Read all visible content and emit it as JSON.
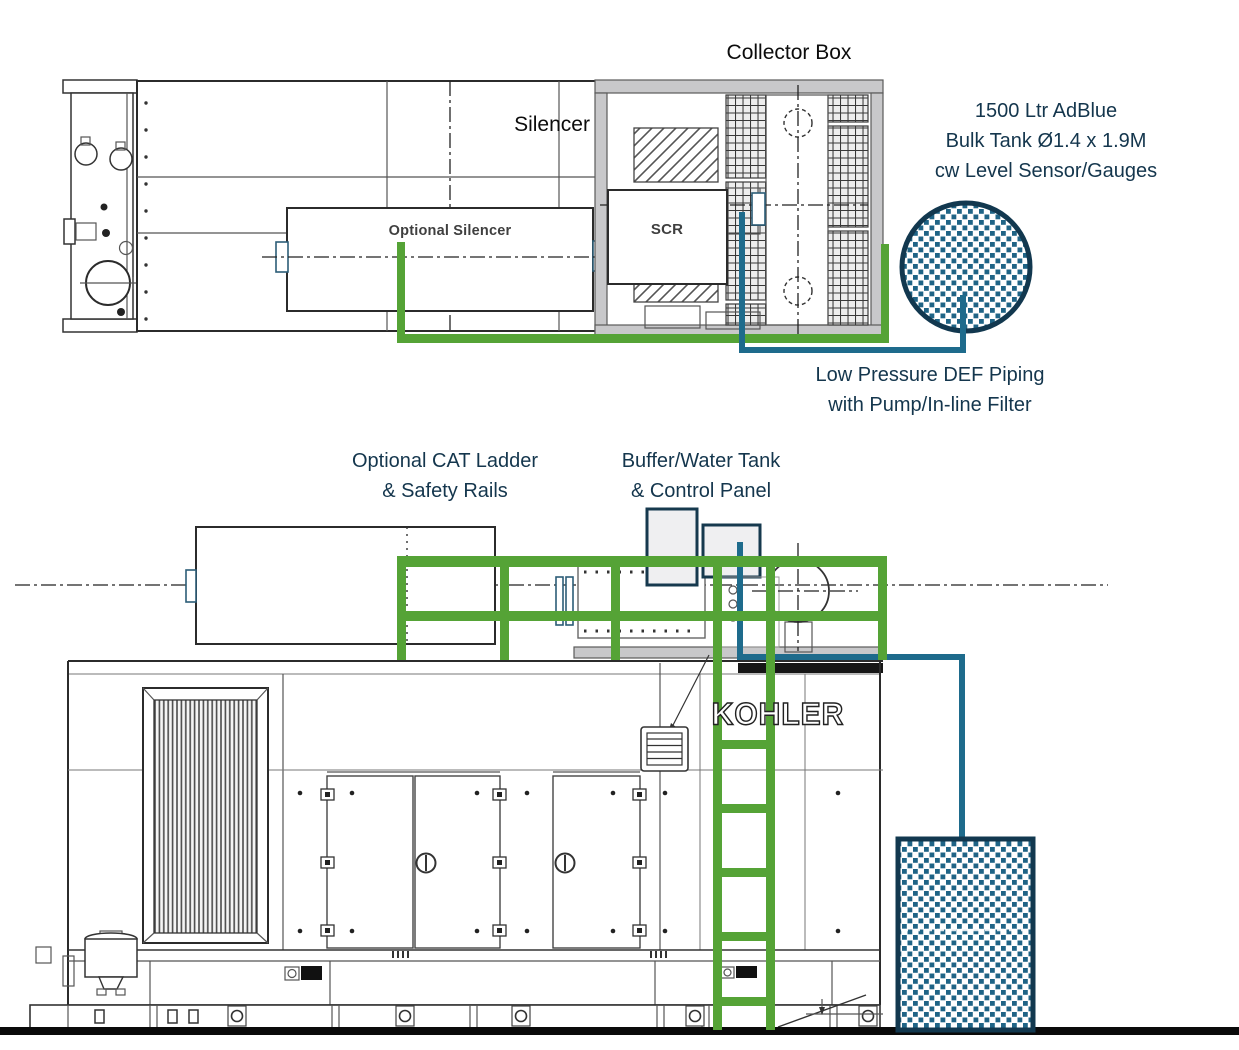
{
  "labels": {
    "collector_box": "Collector Box",
    "silencer": "Silencer",
    "optional_silencer": "Optional Silencer",
    "scr": "SCR",
    "adblue_tank": {
      "line1": "1500 Ltr AdBlue",
      "line2": "Bulk Tank Ø1.4 x 1.9M",
      "line3": "cw Level Sensor/Gauges"
    },
    "def_piping": {
      "line1": "Low Pressure DEF Piping",
      "line2": "with Pump/In-line Filter"
    },
    "cat_ladder": {
      "line1": "Optional CAT Ladder",
      "line2": "& Safety Rails"
    },
    "buffer_tank": {
      "line1": "Buffer/Water Tank",
      "line2": "& Control Panel"
    },
    "logo": "KOHLER"
  },
  "colors": {
    "pipe_green": "#55A336",
    "pipe_teal": "#1E6B8C",
    "tank_fill_teal": "#1F6486",
    "tank_border_navy": "#12384F",
    "panel_border_navy": "#16394E",
    "wall_grey": "#C8C8CA",
    "annotation_text": "#14364D",
    "ground_black": "#0A0A0A"
  }
}
